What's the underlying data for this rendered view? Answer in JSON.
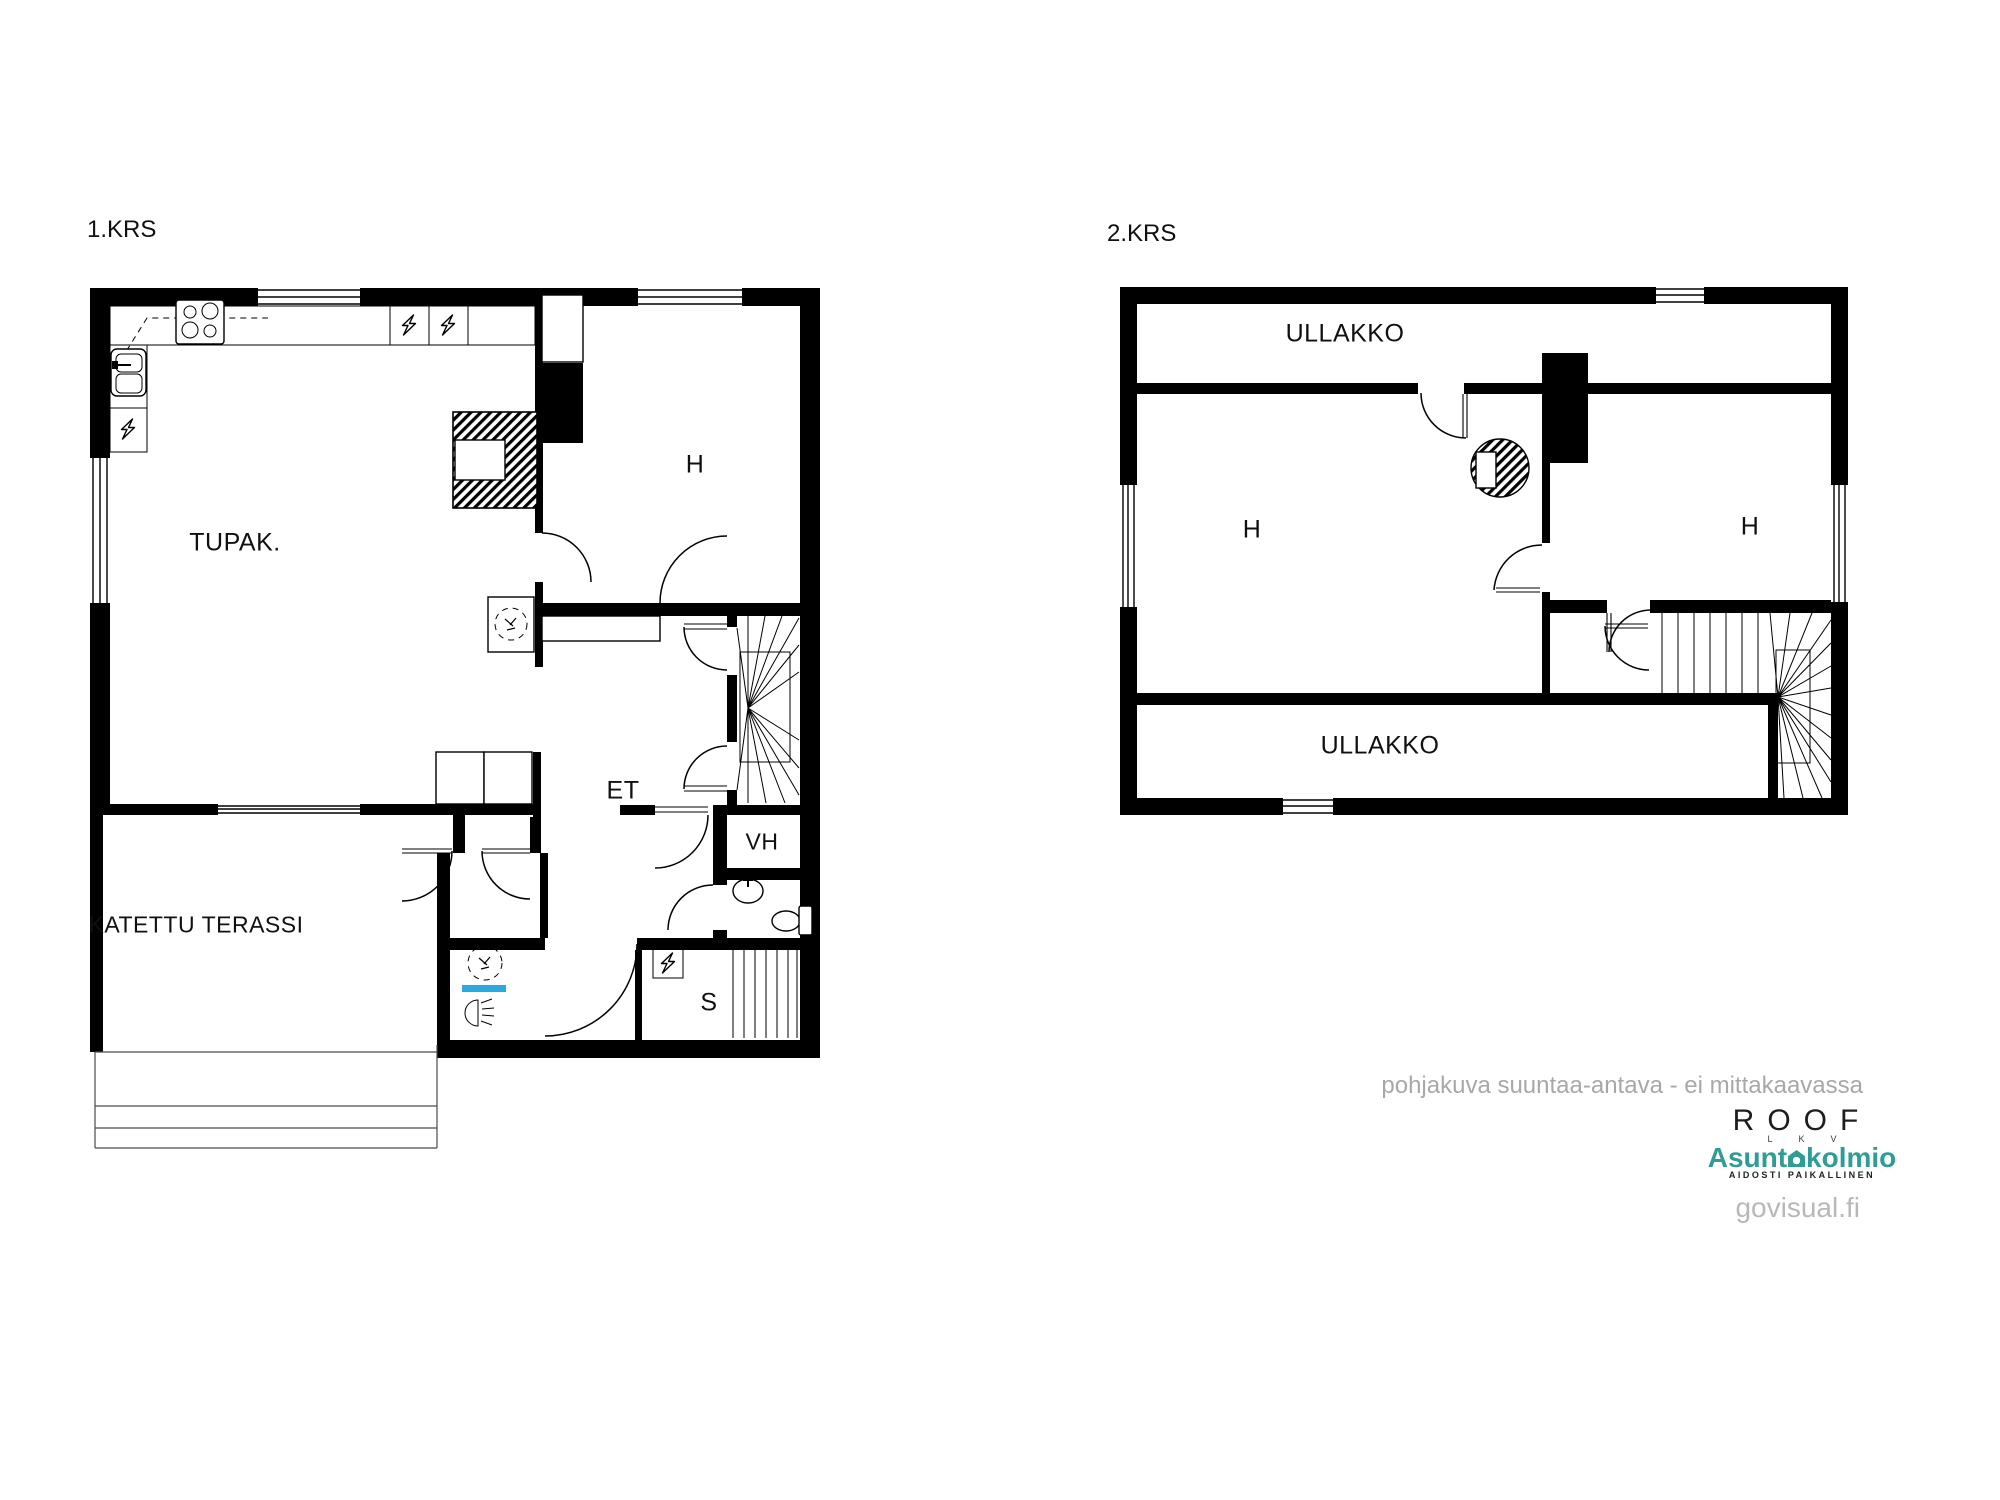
{
  "floor1": {
    "title": "1.KRS",
    "labels": {
      "tupak": "TUPAK.",
      "room_h": "H",
      "hallway": "ET",
      "closet": "VH",
      "sauna": "S",
      "terrace": "KATETTU TERASSI"
    }
  },
  "floor2": {
    "title": "2.KRS",
    "labels": {
      "attic_top": "ULLAKKO",
      "room_h_left": "H",
      "room_h_right": "H",
      "attic_bottom": "ULLAKKO"
    }
  },
  "footer": {
    "disclaimer": "pohjakuva suuntaa-antava - ei mittakaavassa",
    "roof": "ROOF",
    "roof_letters": "LKV",
    "brand_prefix": "Asunt",
    "brand_suffix": "kolmio",
    "tagline": "AIDOSTI PAIKALLINEN",
    "watermark": "govisual.fi"
  },
  "colors": {
    "walls": "#000000",
    "shower_accent": "#29a9e0",
    "brand_teal": "#2f9c96",
    "note_gray": "#a8a8a8",
    "watermark_gray": "#b8b8b8"
  }
}
